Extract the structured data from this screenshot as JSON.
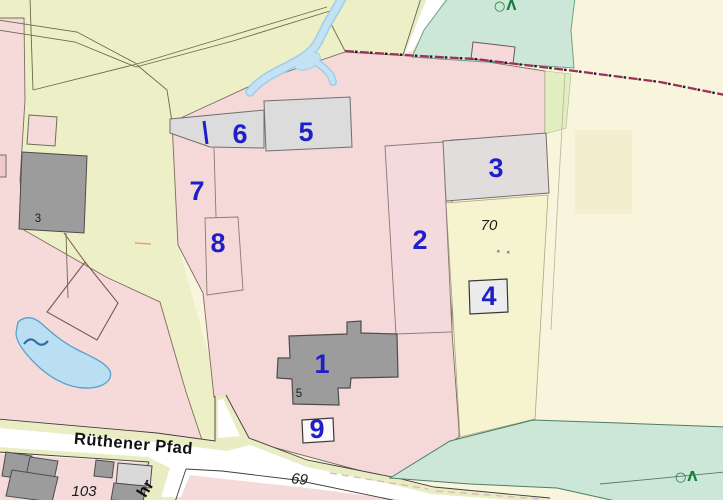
{
  "map": {
    "kind": "cadastral parcel map",
    "street_labels": [
      {
        "label": "Rüthener Pfad"
      },
      {
        "label": "hr"
      }
    ],
    "area_labels": [
      {
        "id": 1,
        "label": "1"
      },
      {
        "id": 2,
        "label": "2"
      },
      {
        "id": 3,
        "label": "3"
      },
      {
        "id": 4,
        "label": "4"
      },
      {
        "id": 5,
        "label": "5"
      },
      {
        "id": 6,
        "label": "6"
      },
      {
        "id": 7,
        "label": "7"
      },
      {
        "id": 8,
        "label": "8"
      },
      {
        "id": 9,
        "label": "9"
      }
    ],
    "house_numbers": [
      {
        "label": "3"
      },
      {
        "label": "5"
      }
    ],
    "parcel_numbers": [
      {
        "label": "69"
      },
      {
        "label": "70"
      },
      {
        "label": "103"
      }
    ],
    "symbols": {
      "water_wave": "~",
      "tree_symbol": "○Λ"
    },
    "colors": {
      "field_green": "#edefc6",
      "pale_yellow": "#f8f5dc",
      "parcel_pink": "#f6d9d9",
      "forest_teal": "#cce6d8",
      "water_blue": "#badff2",
      "building_gray": "#9c9c9c",
      "area_gray": "#dcdcdc",
      "label_blue": "#1f1fc8",
      "boundary_dash_red": "#9e2f5f"
    }
  }
}
